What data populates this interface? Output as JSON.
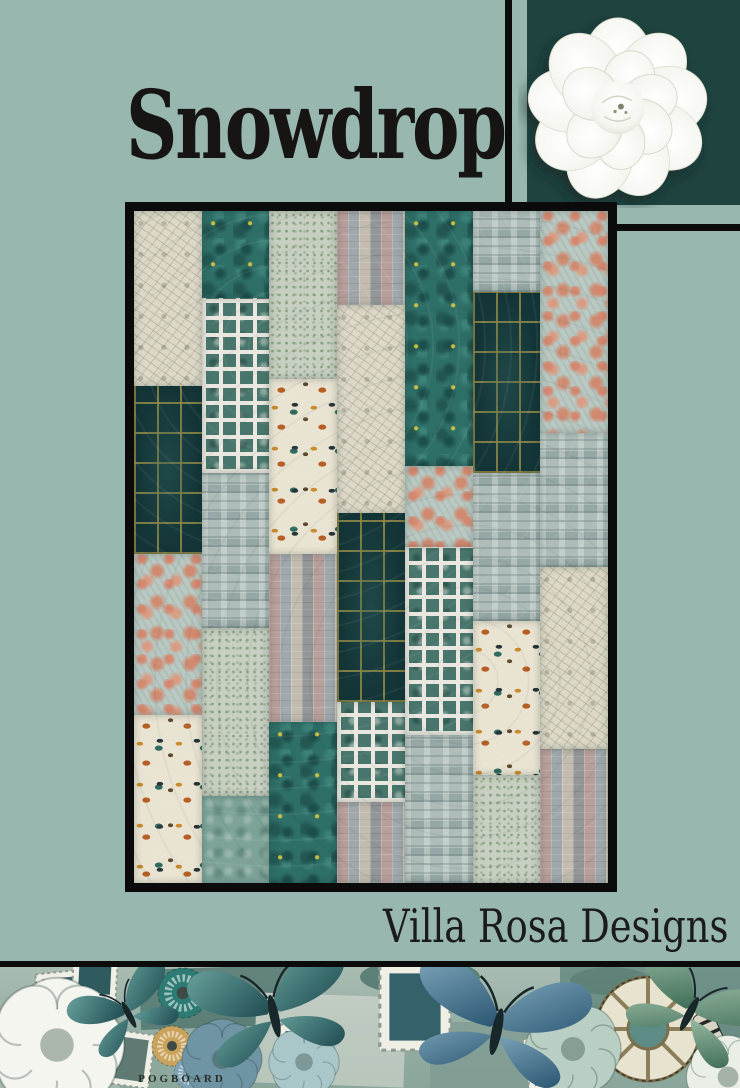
{
  "page": {
    "background_color": "#97b7af",
    "accent_dark": "#1f4440",
    "line_color": "#0c0c0c",
    "title": "Snowdrop"
  },
  "hero": {
    "flower": "white peony photo on dark teal panel"
  },
  "quilt": {
    "description": "photo of patchwork quilt with black binding, seven vertical columns of tall rectangles",
    "fabric_legend": {
      "sketch": "cream botanical sketch print",
      "marble": "dark teal marble with gold flecks",
      "ditsy": "light sage ditsy print",
      "stamps": "vintage postage-stamp collage print",
      "plaid": "dark navy windowpane with gold lines",
      "whitegrid": "white lattice over teal squares",
      "butterfly": "butterfly specimen print",
      "coral": "coral scroll on pale aqua",
      "collage": "pale blue paper-ephemera collage",
      "seafoam": "seafoam texture"
    },
    "columns": [
      [
        {
          "fabric": "sketch",
          "h": 26
        },
        {
          "fabric": "plaid",
          "h": 25
        },
        {
          "fabric": "coral",
          "h": 24
        },
        {
          "fabric": "butterfly",
          "h": 25
        }
      ],
      [
        {
          "fabric": "marble",
          "h": 13
        },
        {
          "fabric": "whitegrid",
          "h": 26
        },
        {
          "fabric": "collage",
          "h": 23
        },
        {
          "fabric": "ditsy",
          "h": 25
        },
        {
          "fabric": "seafoam",
          "h": 13
        }
      ],
      [
        {
          "fabric": "ditsy",
          "h": 25
        },
        {
          "fabric": "butterfly",
          "h": 26
        },
        {
          "fabric": "stamps",
          "h": 25
        },
        {
          "fabric": "marble",
          "h": 24
        }
      ],
      [
        {
          "fabric": "stamps",
          "h": 14
        },
        {
          "fabric": "sketch",
          "h": 31
        },
        {
          "fabric": "plaid",
          "h": 28
        },
        {
          "fabric": "whitegrid",
          "h": 15
        },
        {
          "fabric": "stamps",
          "h": 12
        }
      ],
      [
        {
          "fabric": "marble",
          "h": 38
        },
        {
          "fabric": "coral",
          "h": 12
        },
        {
          "fabric": "whitegrid",
          "h": 28
        },
        {
          "fabric": "collage",
          "h": 22
        }
      ],
      [
        {
          "fabric": "collage",
          "h": 12
        },
        {
          "fabric": "plaid",
          "h": 27
        },
        {
          "fabric": "collage",
          "h": 22
        },
        {
          "fabric": "butterfly",
          "h": 23
        },
        {
          "fabric": "ditsy",
          "h": 16
        }
      ],
      [
        {
          "fabric": "coral",
          "h": 33
        },
        {
          "fabric": "collage",
          "h": 20
        },
        {
          "fabric": "sketch",
          "h": 27
        },
        {
          "fabric": "stamps",
          "h": 20
        }
      ]
    ]
  },
  "brand": {
    "name": "Villa Rosa Designs"
  },
  "footer": {
    "description": "vintage collage strip with teal butterflies, roses, rosettes and postage stamps",
    "ephemera_text": "POGBOARD"
  }
}
